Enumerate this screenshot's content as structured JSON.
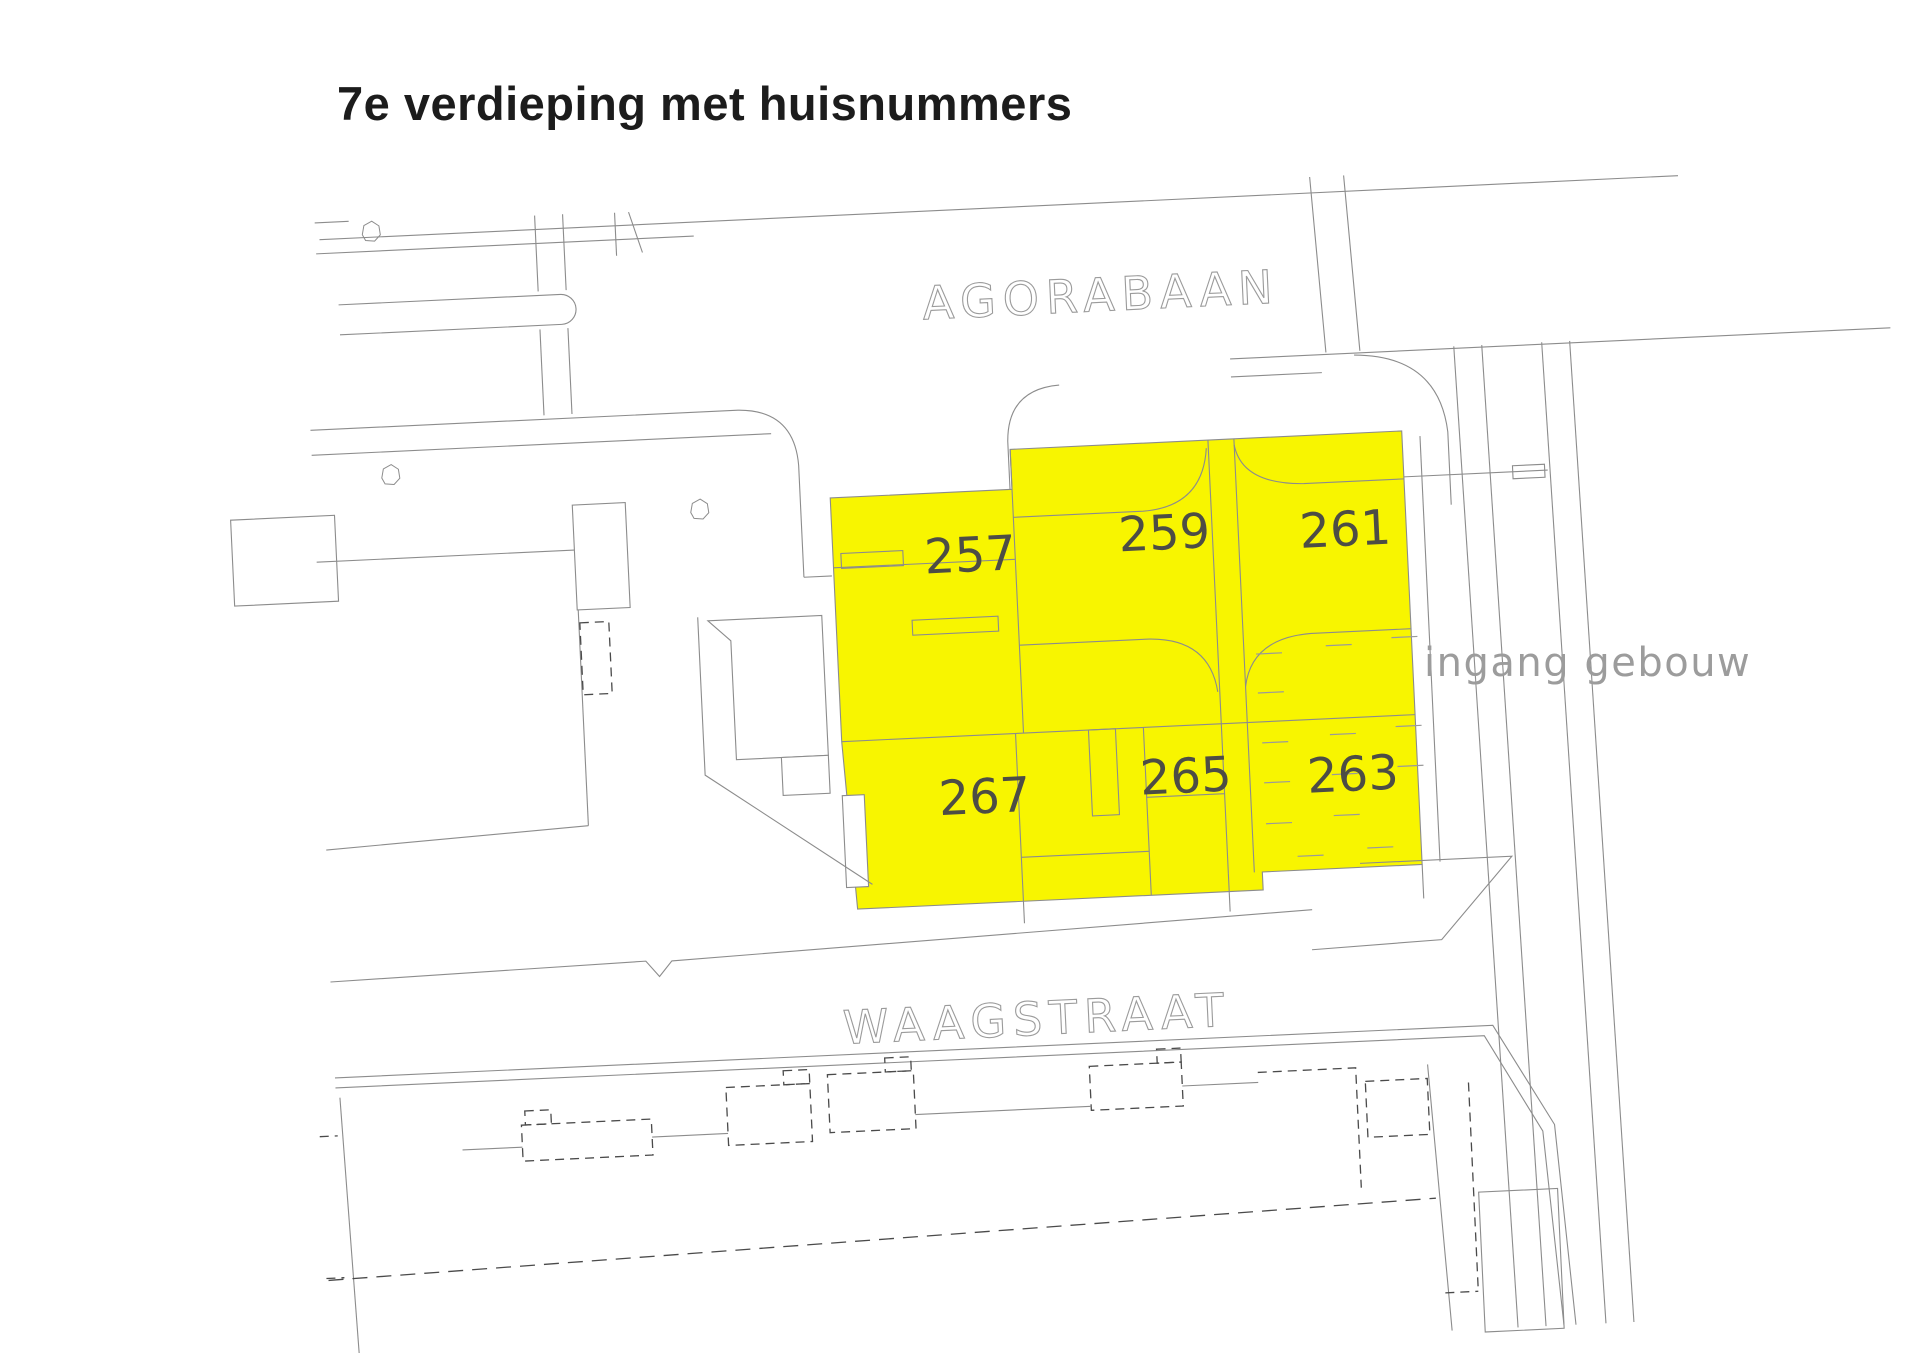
{
  "title": "7e verdieping met huisnummers",
  "plan": {
    "street_top": "AGORABAAN",
    "street_bottom": "WAAGSTRAAT",
    "entrance_label": "ingang gebouw",
    "floor": "7e verdieping",
    "units": [
      {
        "number": "257"
      },
      {
        "number": "259"
      },
      {
        "number": "261"
      },
      {
        "number": "263"
      },
      {
        "number": "265"
      },
      {
        "number": "267"
      }
    ]
  },
  "colors": {
    "highlight": "#F8F500",
    "line": "#8C8C8C",
    "dashed": "#4A4A4A",
    "number": "#4D4D45",
    "street": "#9B9B9B",
    "annotation": "#9C9C9C",
    "title": "#1C1C1C",
    "background": "#FFFFFF"
  }
}
